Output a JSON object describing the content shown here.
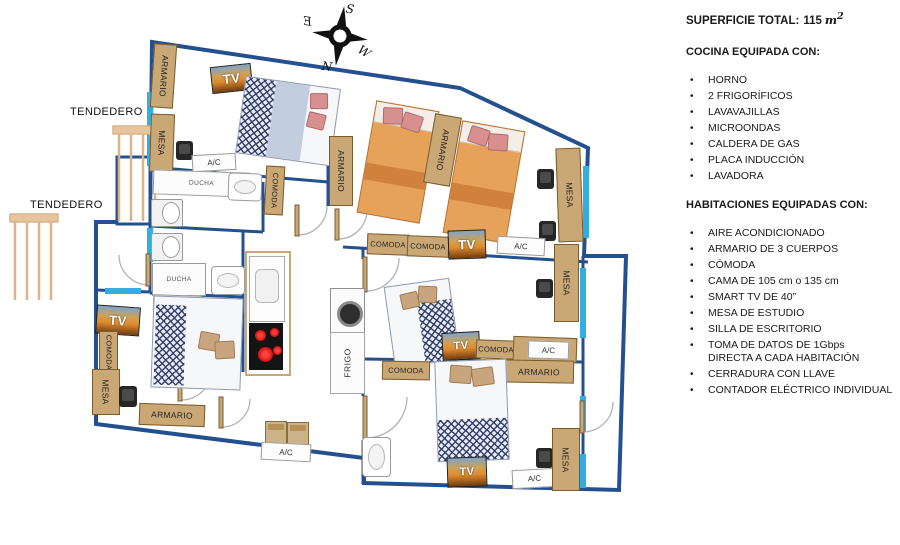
{
  "panel": {
    "superficie_label": "SUPERFICIE TOTAL:",
    "superficie_value": "115",
    "superficie_unit": "m",
    "superficie_exponent": "2",
    "cocina_title": "COCINA EQUIPADA CON:",
    "cocina_items": [
      "HORNO",
      "2 FRIGORÍFICOS",
      "LAVAVAJILLAS",
      "MICROONDAS",
      "CALDERA DE GAS",
      "PLACA INDUCCIÓN",
      "LAVADORA"
    ],
    "habitaciones_title": "HABITACIONES EQUIPADAS CON:",
    "habitaciones_items": [
      "AIRE ACONDICIONADO",
      "ARMARIO DE 3 CUERPOS",
      "CÓMODA",
      "CAMA DE 105 cm o 135 cm",
      "SMART TV DE 40”",
      "MESA DE ESTUDIO",
      "SILLA DE ESCRITORIO",
      "TOMA DE DATOS DE 1Gbps",
      "CERRADURA CON LLAVE",
      "CONTADOR ELÉCTRICO INDIVIDUAL"
    ],
    "toma_line2": "DIRECTA A CADA HABITACIÓN"
  },
  "compass": {
    "north": "N",
    "south": "S",
    "east": "E",
    "west": "W"
  },
  "plan": {
    "labels": {
      "tendedero": "TENDEDERO",
      "armario": "ARMARIO",
      "mesa": "MESA",
      "comoda": "COMODA",
      "ducha": "DUCHA",
      "ac": "A/C",
      "tv": "TV",
      "frigo": "FRIGO"
    }
  },
  "colors": {
    "wall_blue": "#24508F",
    "window_cyan": "#33AEE3",
    "furniture_tan": "#C9A876",
    "bed_orange": "#E7A259",
    "burner_red": "#D42020"
  }
}
